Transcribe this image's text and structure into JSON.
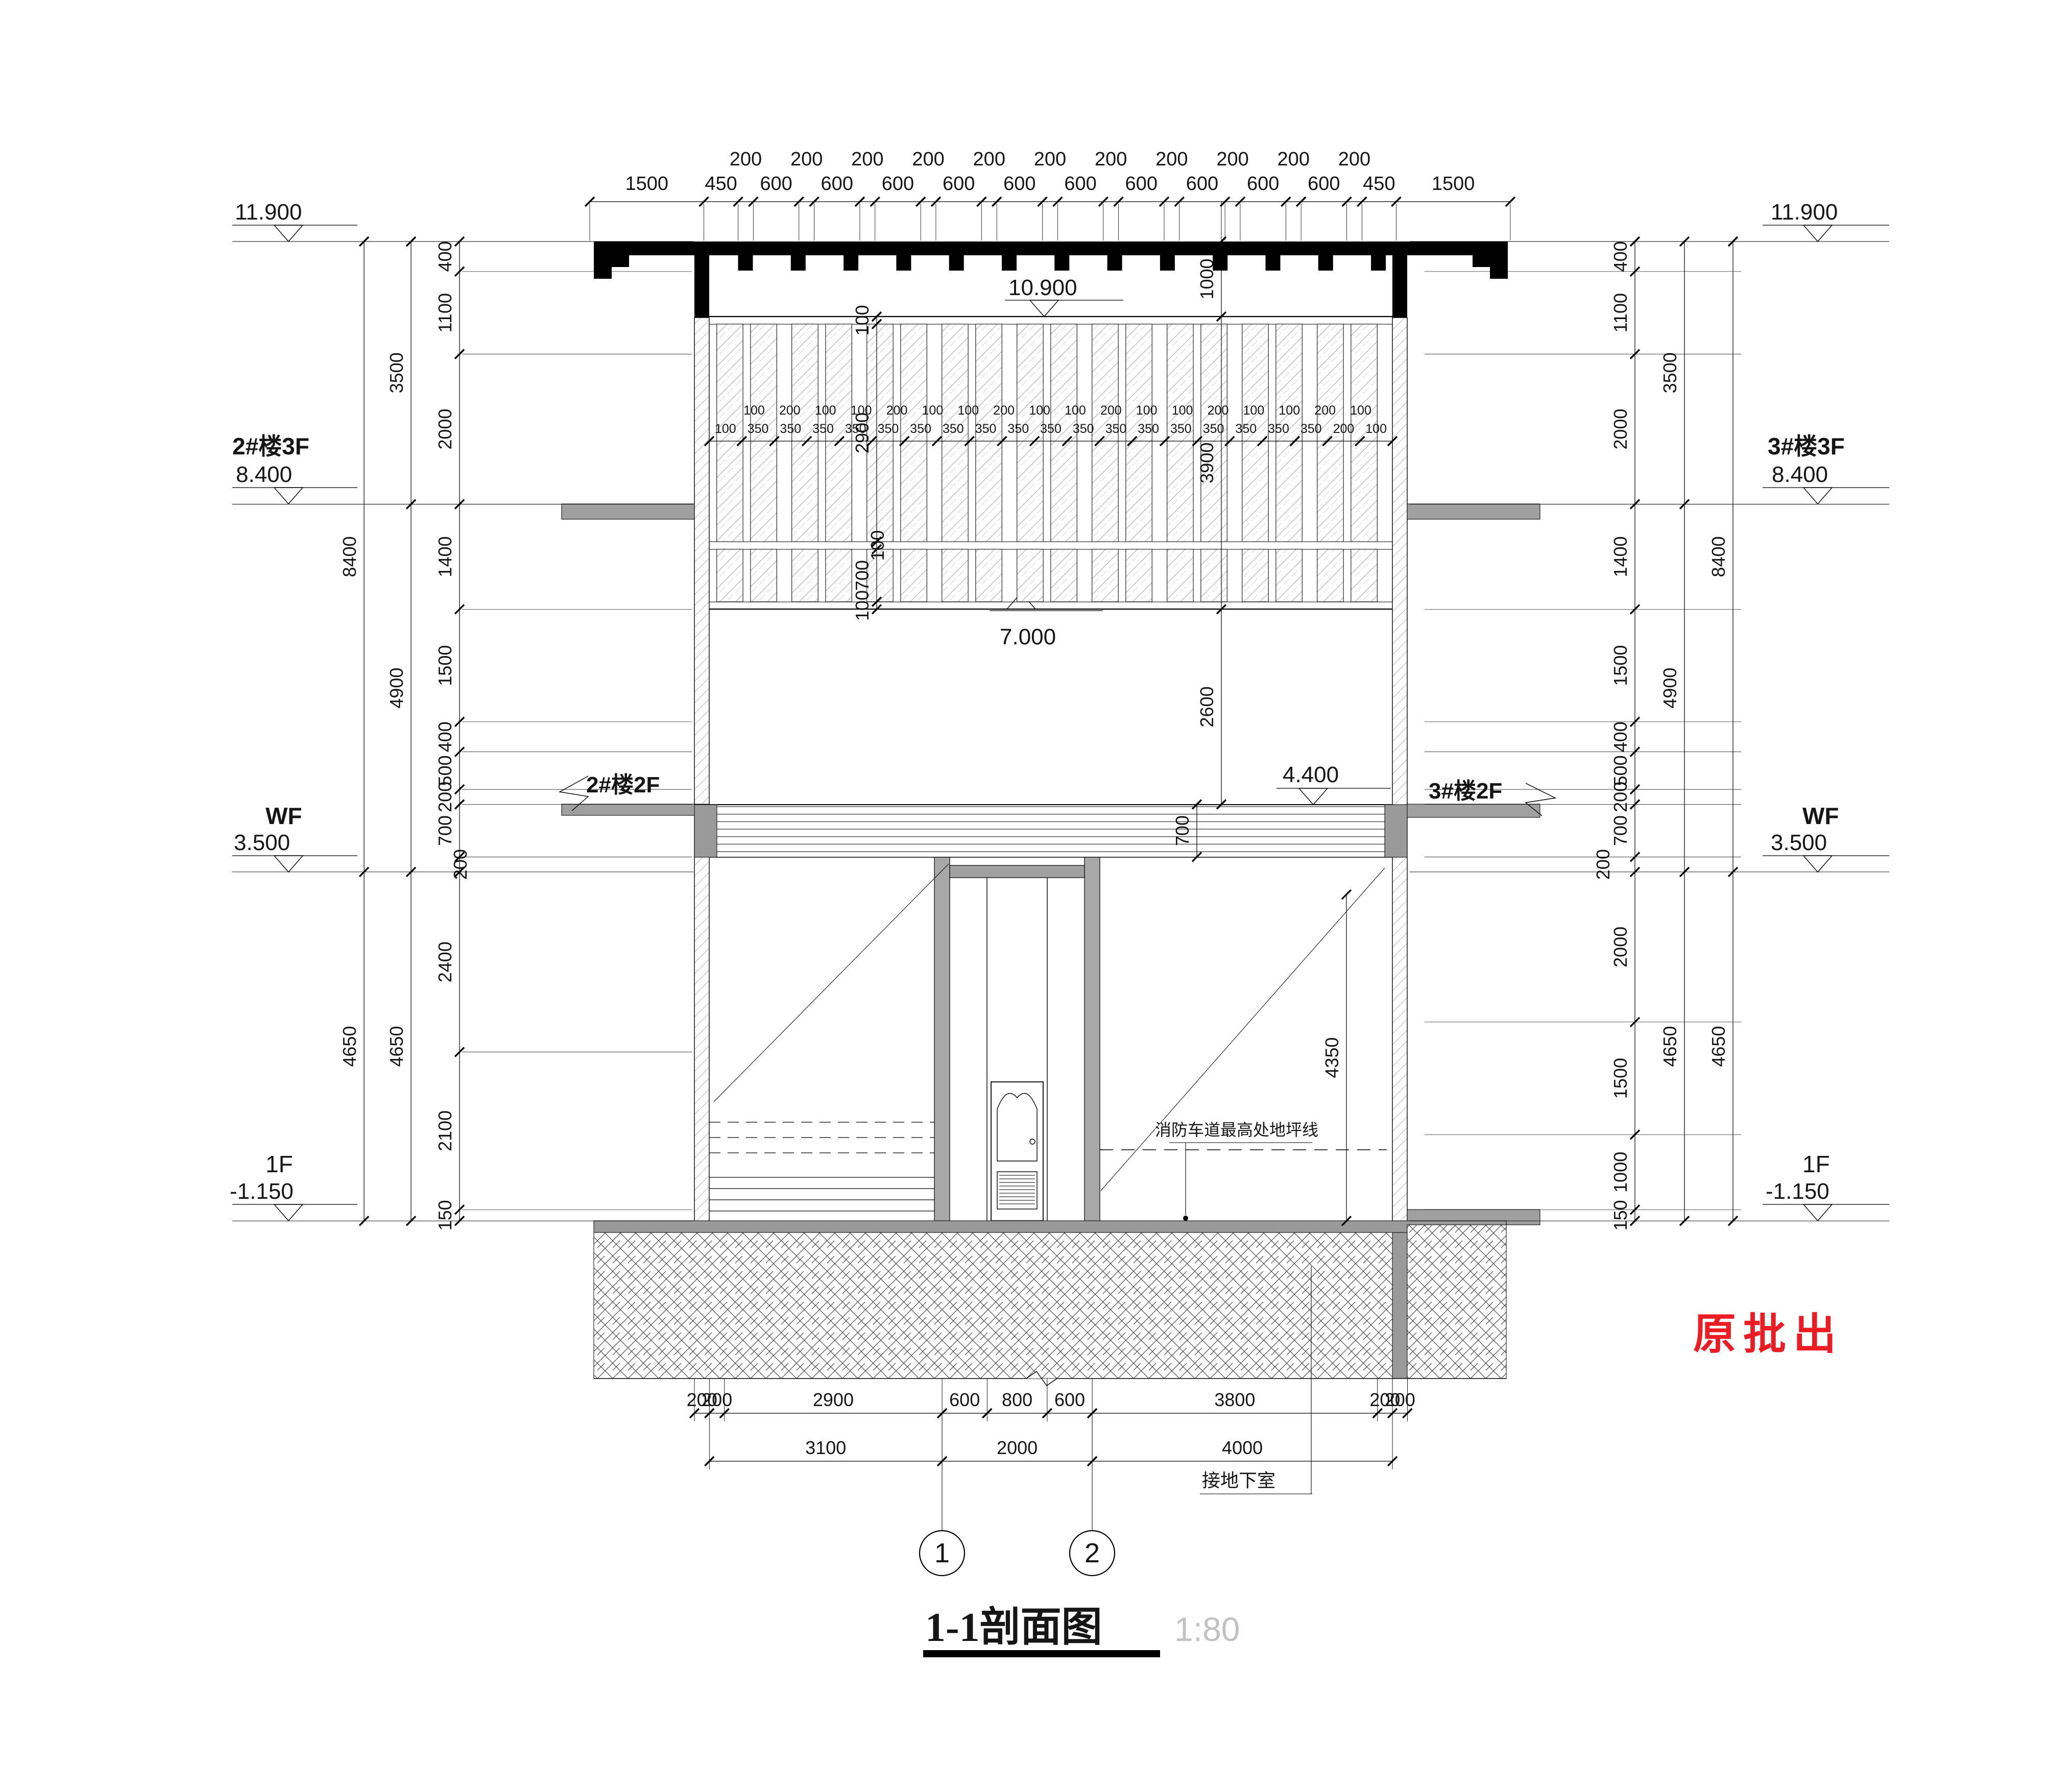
{
  "drawing": {
    "title": "1-1剖面图",
    "scale": "1:80",
    "stamp": "原批出"
  },
  "axes": [
    "1",
    "2"
  ],
  "annotations": {
    "fire_lane_line": "消防车道最高处地坪线",
    "to_basement": "接地下室",
    "left_floor2": "2#楼2F",
    "right_floor2": "3#楼2F"
  },
  "levels": {
    "left": [
      {
        "name": "",
        "elev": "11.900"
      },
      {
        "name": "2#楼3F",
        "elev": "8.400"
      },
      {
        "name": "WF",
        "elev": "3.500"
      },
      {
        "name": "1F",
        "elev": "-1.150"
      }
    ],
    "right": [
      {
        "name": "",
        "elev": "11.900"
      },
      {
        "name": "3#楼3F",
        "elev": "8.400"
      },
      {
        "name": "WF",
        "elev": "3.500"
      },
      {
        "name": "1F",
        "elev": "-1.150"
      }
    ],
    "interior": [
      {
        "elev": "10.900"
      },
      {
        "elev": "7.000"
      },
      {
        "elev": "4.400"
      }
    ]
  },
  "dims": {
    "top_main": [
      "1500",
      "450",
      "600",
      "600",
      "600",
      "600",
      "600",
      "600",
      "600",
      "600",
      "600",
      "600",
      "450",
      "1500"
    ],
    "top_offset": [
      "200",
      "200",
      "200",
      "200",
      "200",
      "200",
      "200",
      "200",
      "200",
      "200",
      "200"
    ],
    "left_inner": [
      "400",
      "1100",
      "2000",
      "1400",
      "1500",
      "400",
      "500",
      "200",
      "700",
      "200",
      "2400",
      "2100",
      "150"
    ],
    "left_mid": [
      "3500",
      "4900",
      "4650"
    ],
    "left_outer": [
      "8400",
      "4650"
    ],
    "right_inner": [
      "400",
      "1100",
      "2000",
      "1400",
      "1500",
      "400",
      "500",
      "200",
      "700",
      "200",
      "2000",
      "1500",
      "1000",
      "150"
    ],
    "right_mid": [
      "3500",
      "4900",
      "4650"
    ],
    "right_outer": [
      "8400",
      "4650"
    ],
    "window_left": [
      "100",
      "2900",
      "100",
      "700",
      "100"
    ],
    "center_right": [
      "1000",
      "3900",
      "2600"
    ],
    "band_depth": [
      "700"
    ],
    "ramp_height": [
      "4350"
    ],
    "sill_upper": [
      "100",
      "200",
      "100",
      "100",
      "200",
      "100",
      "100",
      "200",
      "100",
      "100",
      "200",
      "100",
      "100",
      "200",
      "100",
      "100",
      "200",
      "100"
    ],
    "sill_lower": [
      "100",
      "350",
      "350",
      "350",
      "350",
      "350",
      "350",
      "350",
      "350",
      "350",
      "350",
      "350",
      "350",
      "350",
      "350",
      "350",
      "350",
      "350",
      "350",
      "200",
      "100"
    ],
    "bottom_row1": [
      "200",
      "200",
      "2900",
      "600",
      "800",
      "600",
      "3800",
      "200",
      "200"
    ],
    "bottom_row2": [
      "3100",
      "2000",
      "4000"
    ]
  }
}
